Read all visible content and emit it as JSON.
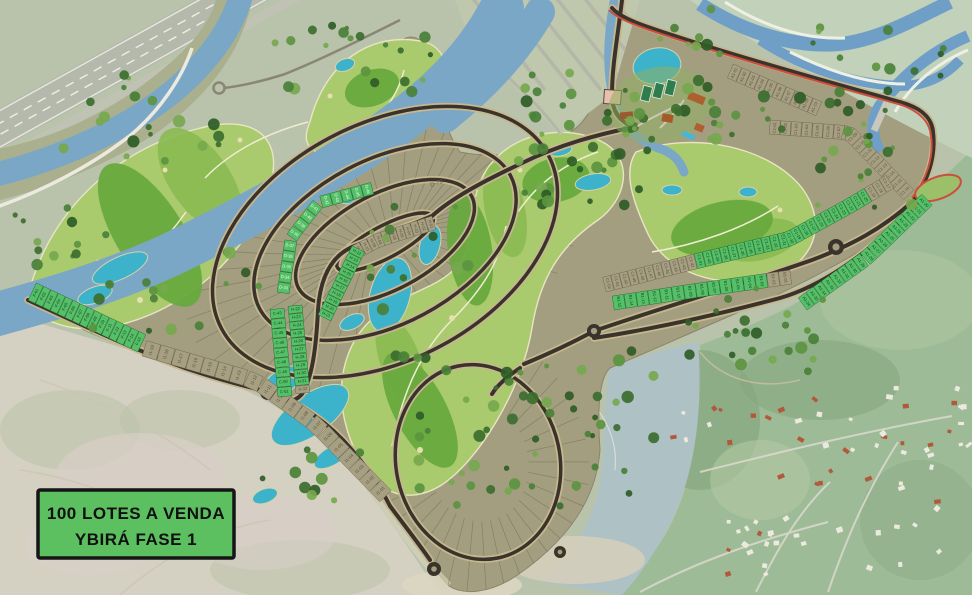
{
  "legend": {
    "line1": "100 LOTES A VENDA",
    "line2": "YBIRÁ FASE 1"
  },
  "road_labels": [
    "D-79"
  ],
  "colors": {
    "available_lot": "#54c169",
    "available_lot_edge": "#2c6b33",
    "reserved_lot": "#a79f81",
    "reserved_lot_edge": "#6f6852",
    "road": "#3a332b",
    "road_casing": "#c6b78f",
    "river": "#7ba7c7",
    "lake": "#3db3cb",
    "golf_light": "#a9ca6d",
    "golf_dark": "#69a93e",
    "dev_ground": "#a49e80",
    "legend_bg": "#5cbf60",
    "legend_border": "#151515",
    "bike_path": "#cc4f3d"
  },
  "lot_strips": [
    {
      "id": "F",
      "labels": [
        "F-01",
        "F-02",
        "F-03",
        "F-04",
        "F-05",
        "F-06",
        "F-07",
        "F-08",
        "F-09",
        "F-10",
        "F-11",
        "F-12",
        "F-13",
        "F-14",
        "F-15"
      ],
      "sale": [
        1,
        1,
        1,
        1,
        1,
        1,
        1,
        1,
        1,
        1,
        1,
        1,
        1,
        1,
        1
      ]
    },
    {
      "id": "I1",
      "labels": [
        "I1-19",
        "I1-18",
        "I1-17",
        "I1-16",
        "I1-15",
        "I1-14",
        "I1-13",
        "I1-12",
        "I1-11",
        "I1-10",
        "I1-09",
        "I1-08",
        "I1-07",
        "I1-06",
        "I1-05",
        "I1-04",
        "I1-03",
        "I1-02",
        "I1-01"
      ],
      "sale": [
        0,
        0,
        0,
        0,
        0,
        0,
        0,
        0,
        0,
        0,
        0,
        0,
        0,
        0,
        0,
        0,
        0,
        0,
        0
      ]
    },
    {
      "id": "H1",
      "labels": [
        "H-01",
        "H-02",
        "H-03",
        "H-04",
        "H-05",
        "H-06",
        "H-07",
        "H-08",
        "H-09",
        "H-10",
        "H-11",
        "H-12",
        "H-13",
        "H-14",
        "H-15",
        "H-16",
        "H-17",
        "H-18",
        "H-19",
        "H-20",
        "H-21"
      ],
      "sale": [
        0,
        0,
        0,
        0,
        0,
        0,
        0,
        0,
        0,
        0,
        0,
        1,
        1,
        1,
        1,
        1,
        1,
        1,
        1,
        1,
        1
      ]
    },
    {
      "id": "H2",
      "labels": [
        "H-22",
        "H-23",
        "H-24",
        "H-25",
        "H-26",
        "H-27",
        "H-28",
        "H-29",
        "H-30",
        "H-31",
        "H-32"
      ],
      "sale": [
        1,
        1,
        1,
        1,
        1,
        1,
        1,
        1,
        1,
        1,
        0
      ]
    },
    {
      "id": "C",
      "labels": [
        "C-43",
        "C-44",
        "C-45",
        "C-46",
        "C-47",
        "C-48",
        "C-49",
        "C-50",
        "C-51"
      ],
      "sale": [
        1,
        1,
        1,
        1,
        1,
        1,
        1,
        1,
        1
      ]
    },
    {
      "id": "D",
      "labels": [
        "D-33",
        "D-34",
        "D-35",
        "D-36",
        "D-37",
        "D-38",
        "D-39",
        "D-40",
        "D-41",
        "D-42",
        "D-43",
        "D-44",
        "D-45",
        "D-46"
      ],
      "sale": [
        1,
        1,
        1,
        1,
        1,
        1,
        1,
        1,
        1,
        1,
        1,
        1,
        1,
        1
      ]
    },
    {
      "id": "A1t",
      "labels": [
        "A1-01",
        "A1-02",
        "A1-03",
        "A1-04",
        "A1-05",
        "A1-06",
        "A1-07",
        "A1-08",
        "A1-09",
        "A1-10"
      ],
      "sale": [
        0,
        0,
        0,
        0,
        0,
        0,
        0,
        0,
        0,
        0
      ]
    },
    {
      "id": "C1t",
      "labels": [
        "C1-01",
        "C1-02",
        "C1-03",
        "C1-04",
        "C1-05",
        "C1-06",
        "C1-07",
        "C1-08",
        "C1-09",
        "C1-10",
        "C1-11",
        "C1-12",
        "C1-13",
        "C1-14",
        "C1-15",
        "C1-16"
      ],
      "sale": [
        0,
        0,
        0,
        0,
        0,
        0,
        0,
        0,
        0,
        0,
        0,
        0,
        0,
        0,
        0,
        0
      ]
    },
    {
      "id": "C1m",
      "labels": [
        "C1-52",
        "C1-51",
        "C1-50",
        "C1-49",
        "C1-48",
        "C1-47",
        "C1-46",
        "C1-45",
        "C1-44",
        "C1-43",
        "C1-42",
        "C1-41",
        "C1-40",
        "C1-39",
        "C1-38",
        "C1-37",
        "C1-36",
        "C1-35",
        "C1-34",
        "C1-33",
        "C1-32",
        "C1-31",
        "C1-30",
        "C1-29",
        "C1-28",
        "C1-27",
        "C1-26",
        "C1-25",
        "C1-24",
        "C1-23",
        "C1-22",
        "C1-21",
        "C1-20",
        "C1-19",
        "C1-18",
        "C1-17"
      ],
      "sale": [
        0,
        0,
        0,
        0,
        0,
        0,
        0,
        0,
        0,
        0,
        0,
        1,
        1,
        1,
        1,
        1,
        1,
        1,
        1,
        1,
        1,
        1,
        1,
        1,
        1,
        1,
        1,
        1,
        1,
        1,
        1,
        1,
        1,
        0,
        0,
        0
      ]
    },
    {
      "id": "B1",
      "labels": [
        "B1-15",
        "B1-14",
        "B1-13",
        "B1-12",
        "B1-11",
        "B1-10",
        "B1-09",
        "B1-08",
        "B1-07",
        "B1-06",
        "B1-05",
        "B1-04",
        "B1-03",
        "B1-02",
        "B1-01"
      ],
      "sale": [
        1,
        1,
        1,
        1,
        1,
        1,
        1,
        1,
        1,
        1,
        1,
        1,
        1,
        0,
        0
      ]
    },
    {
      "id": "A1c",
      "labels": [
        "A1-36",
        "A1-35",
        "A1-34",
        "A1-33",
        "A1-32",
        "A1-31",
        "A1-30",
        "A1-29",
        "A1-28",
        "A1-27",
        "A1-26",
        "A1-25",
        "A1-24",
        "A1-23",
        "A1-22",
        "A1-21",
        "A1-20"
      ],
      "sale": [
        1,
        1,
        1,
        1,
        1,
        1,
        1,
        1,
        1,
        1,
        1,
        1,
        1,
        1,
        1,
        1,
        1
      ]
    }
  ]
}
